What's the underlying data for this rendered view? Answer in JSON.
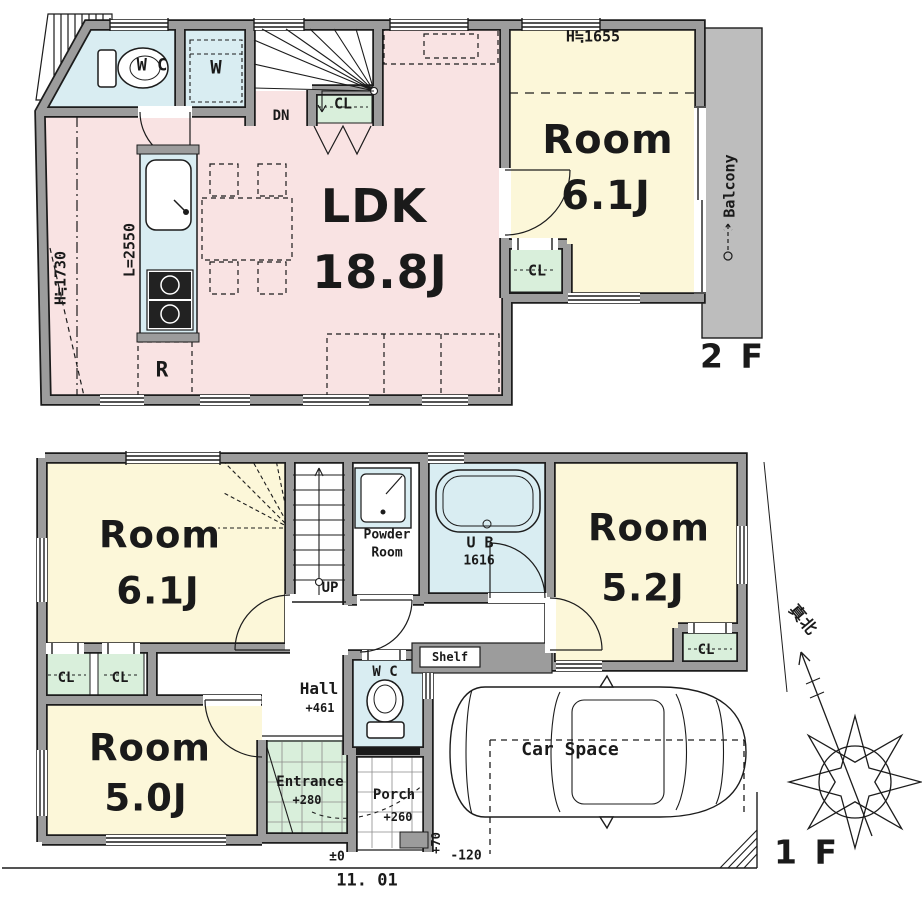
{
  "colors": {
    "wall_gray": "#9c9c9c",
    "ldk_pink": "#f9e3e3",
    "room_yellow": "#fcf7d9",
    "water_blue": "#d9edf2",
    "closet_green": "#d9efdb",
    "balcony_gray": "#bdbdbd",
    "line_black": "#1c1c1c"
  },
  "floor2": {
    "floor_label": "2 F",
    "ldk_name": "LDK",
    "ldk_size": "18.8J",
    "room_name": "Room",
    "room_size": "6.1J",
    "room_height_note": "H≒1655",
    "left_height_note": "H≒1730",
    "kitchen_counter_length": "L=2550",
    "refrigerator": "R",
    "toilet": "W C",
    "washer": "W",
    "stairs_down": "DN",
    "closet_hall": "CL",
    "closet_room": "CL",
    "balcony": "Balcony"
  },
  "floor1": {
    "floor_label": "1 F",
    "room_a_name": "Room",
    "room_a_size": "6.1J",
    "room_b_name": "Room",
    "room_b_size": "5.2J",
    "room_c_name": "Room",
    "room_c_size": "5.0J",
    "stairs_up": "UP",
    "powder_line1": "Powder",
    "powder_line2": "Room",
    "bath_name": "U B",
    "bath_size": "1616",
    "toilet": "W C",
    "hall_name": "Hall",
    "hall_level": "+461",
    "shelf": "Shelf",
    "closet_a": "CL",
    "closet_b": "CL",
    "closet_room_b": "CL",
    "entrance_name": "Entrance",
    "entrance_level": "+280",
    "porch_name": "Porch",
    "porch_level": "+260",
    "car_space": "Car Space",
    "ground_level": "±0",
    "step_level": "+70",
    "car_level": "-120",
    "site_width": "11. 01",
    "north_label": "真北"
  }
}
